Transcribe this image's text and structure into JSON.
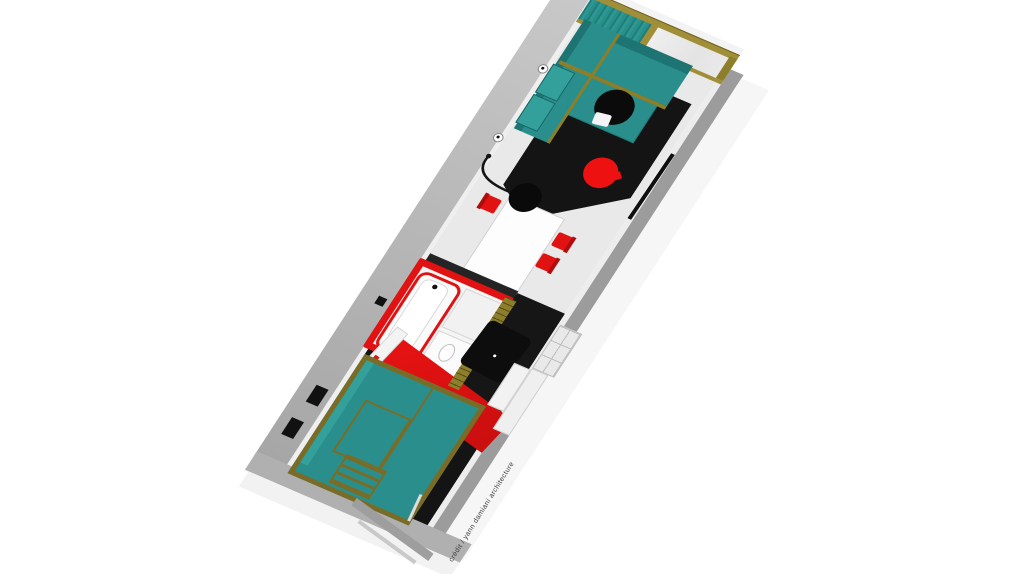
{
  "credit": "crédit / yann damiani architecture",
  "colors": {
    "teal": "#2a8f8c",
    "teal_light": "#34a09c",
    "teal_dark": "#1e7472",
    "wood": "#a08f38",
    "wood_dark": "#8d7e2a",
    "red": "#e01212",
    "red_bright": "#ee1111",
    "blue": "#1a3bbf",
    "floor_dark": "#141414",
    "floor_light": "#e9e9e9",
    "wall_grey": "#b0b0b0",
    "band_grey": "#9c9c9c",
    "glazing": "#e4e4e4",
    "black": "#0b0b0b"
  },
  "plan": {
    "view": "axonometric 3D floor plan of a long narrow dwelling, rotated diagonally",
    "rooms": [
      {
        "name": "living room",
        "furniture": [
          "L-shaped teal sofa",
          "round black coffee table",
          "red round pouf",
          "black arc floor lamp",
          "2 wall lamps",
          "black TV shelf"
        ]
      },
      {
        "name": "dining area",
        "furniture": [
          "white rectangular table",
          "3 red chairs"
        ]
      },
      {
        "name": "bathroom",
        "furniture": [
          "bathtub with red rim",
          "shower tray",
          "vanity with sink"
        ],
        "wall_color": "red"
      },
      {
        "name": "kitchen corridor",
        "furniture": [
          "black panel on wood slat wall",
          "white counter",
          "open shelving cubbies"
        ]
      },
      {
        "name": "bedroom",
        "furniture": [
          "teal double bed with wood frame",
          "slatted ladder",
          "2 black wall windows"
        ]
      }
    ],
    "window_wall": [
      "wood frame",
      "teal pleated curtain",
      "glazed panel"
    ]
  }
}
